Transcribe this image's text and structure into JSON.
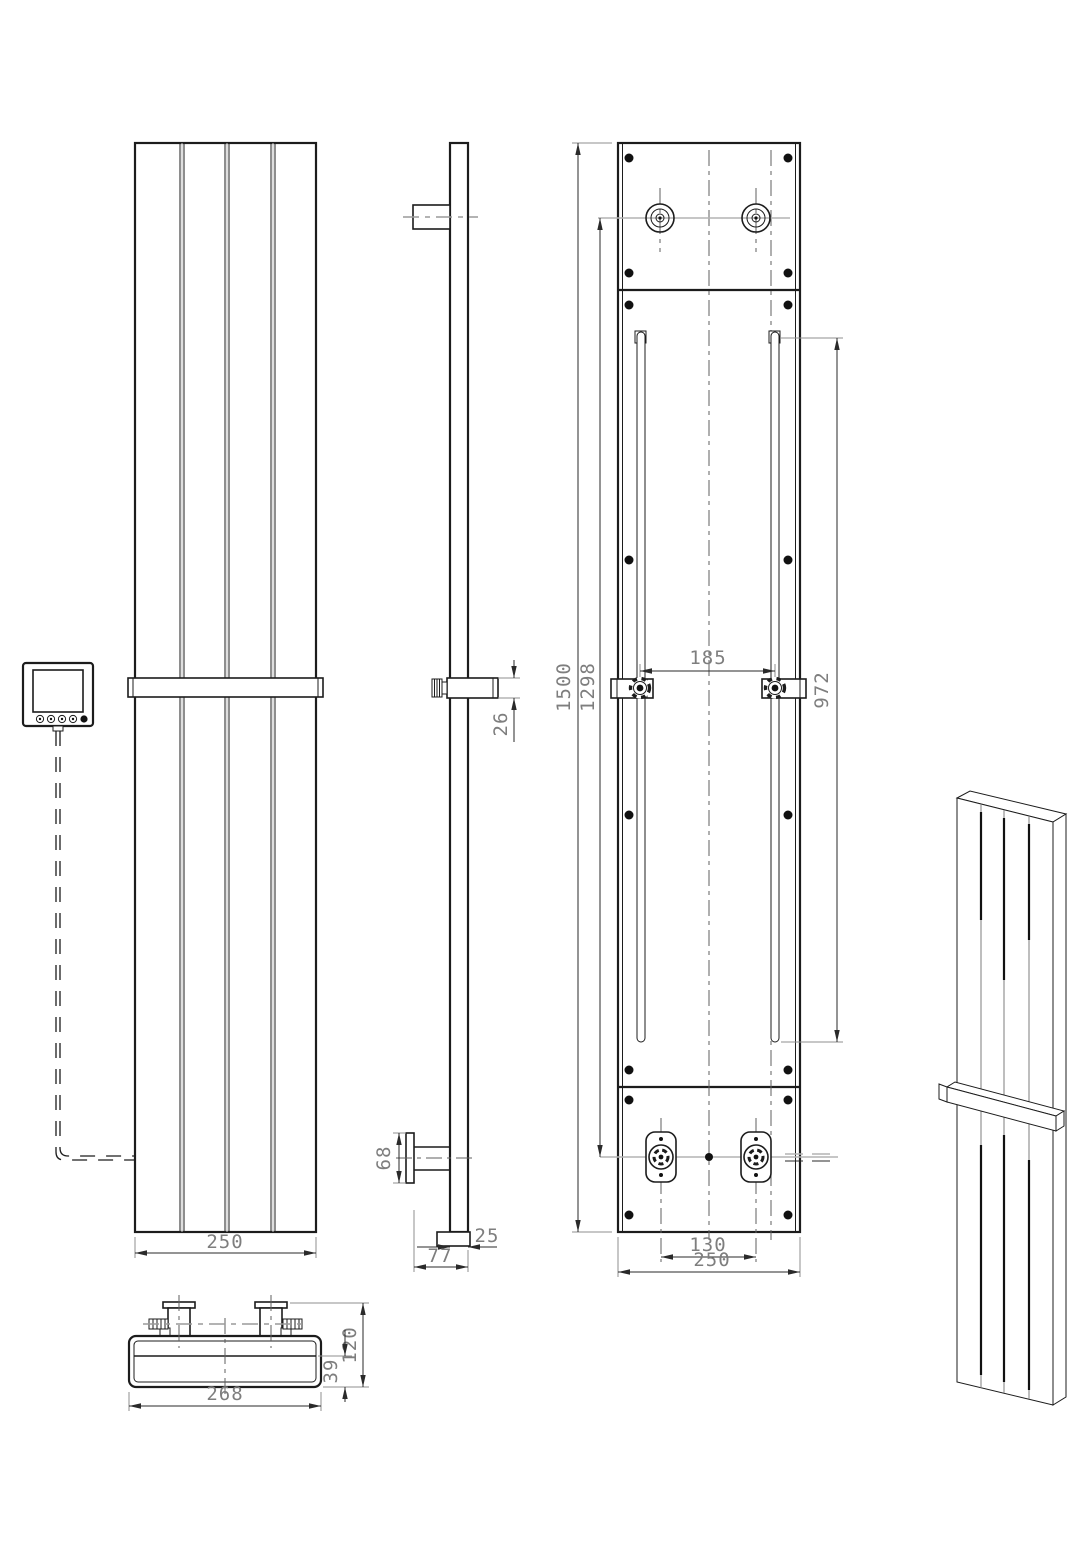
{
  "drawing": {
    "meta": {
      "background": "#ffffff",
      "line_color": "#1c1c1c",
      "dim_text_color": "#7e7e7e",
      "subject": "vertical-panel-radiator-technical-drawing"
    },
    "dims": {
      "front_width": "250",
      "depth_total": "77",
      "panel_depth": "25",
      "flange_height": "68",
      "bar_offset": "26",
      "height_total": "1500",
      "inlet_center_height": "1298",
      "slot_length": "972",
      "bracket_spacing": "185",
      "valve_spacing": "130",
      "back_width": "250",
      "bottom_width": "268",
      "bottom_height_total": "120",
      "bottom_body_height": "39"
    }
  }
}
